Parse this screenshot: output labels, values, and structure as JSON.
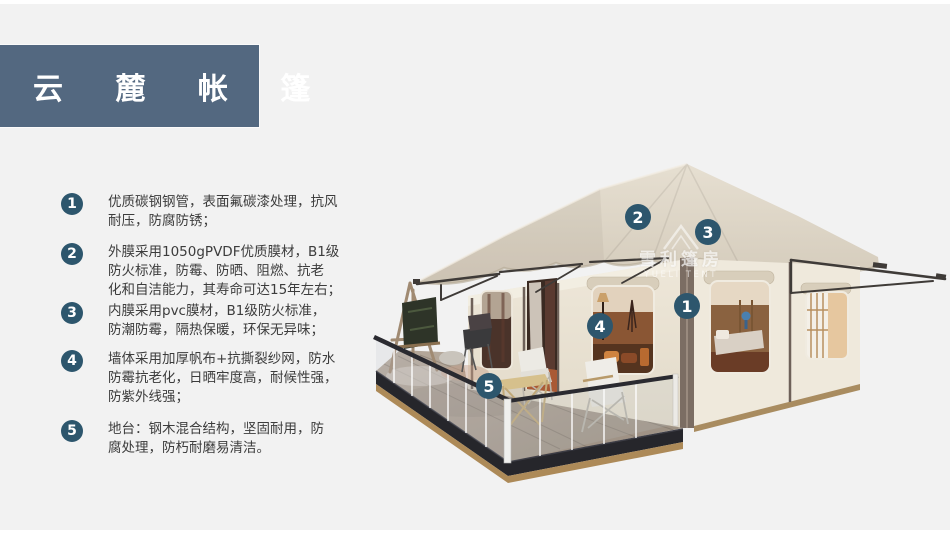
{
  "header": {
    "title": "云 麓 帐 篷"
  },
  "features": [
    {
      "num": "1",
      "text": "优质碳钢钢管，表面氟碳漆处理，抗风\n耐压，防腐防锈；"
    },
    {
      "num": "2",
      "text": "外膜采用1050gPVDF优质膜材，B1级\n防火标准，防霉、防晒、阻燃、抗老\n化和自洁能力，其寿命可达15年左右；"
    },
    {
      "num": "3",
      "text": "内膜采用pvc膜材，B1级防火标准，\n防潮防霉，隔热保暖，环保无异味；"
    },
    {
      "num": "4",
      "text": "墙体采用加厚帆布+抗撕裂纱网，防水\n防霉抗老化，日晒牢度高，耐候性强，\n防紫外线强；"
    },
    {
      "num": "5",
      "text": "地台：钢木混合结构，坚固耐用，防\n腐处理，防朽耐磨易清洁。"
    }
  ],
  "callouts": [
    {
      "label": "1"
    },
    {
      "label": "2"
    },
    {
      "label": "3"
    },
    {
      "label": "4"
    },
    {
      "label": "5"
    }
  ],
  "watermark": {
    "line1": "雪利篷房",
    "line2": "YUELI TENT"
  },
  "colors": {
    "banner": "#536880",
    "marker": "#2d566d",
    "body_text": "#3c3c3c",
    "background": "#f2f2f2",
    "roof": "#dcd4c6",
    "wall": "#e9e2d4",
    "deck_fascia": "#26262b",
    "deck_wood": "#ad8a58"
  }
}
